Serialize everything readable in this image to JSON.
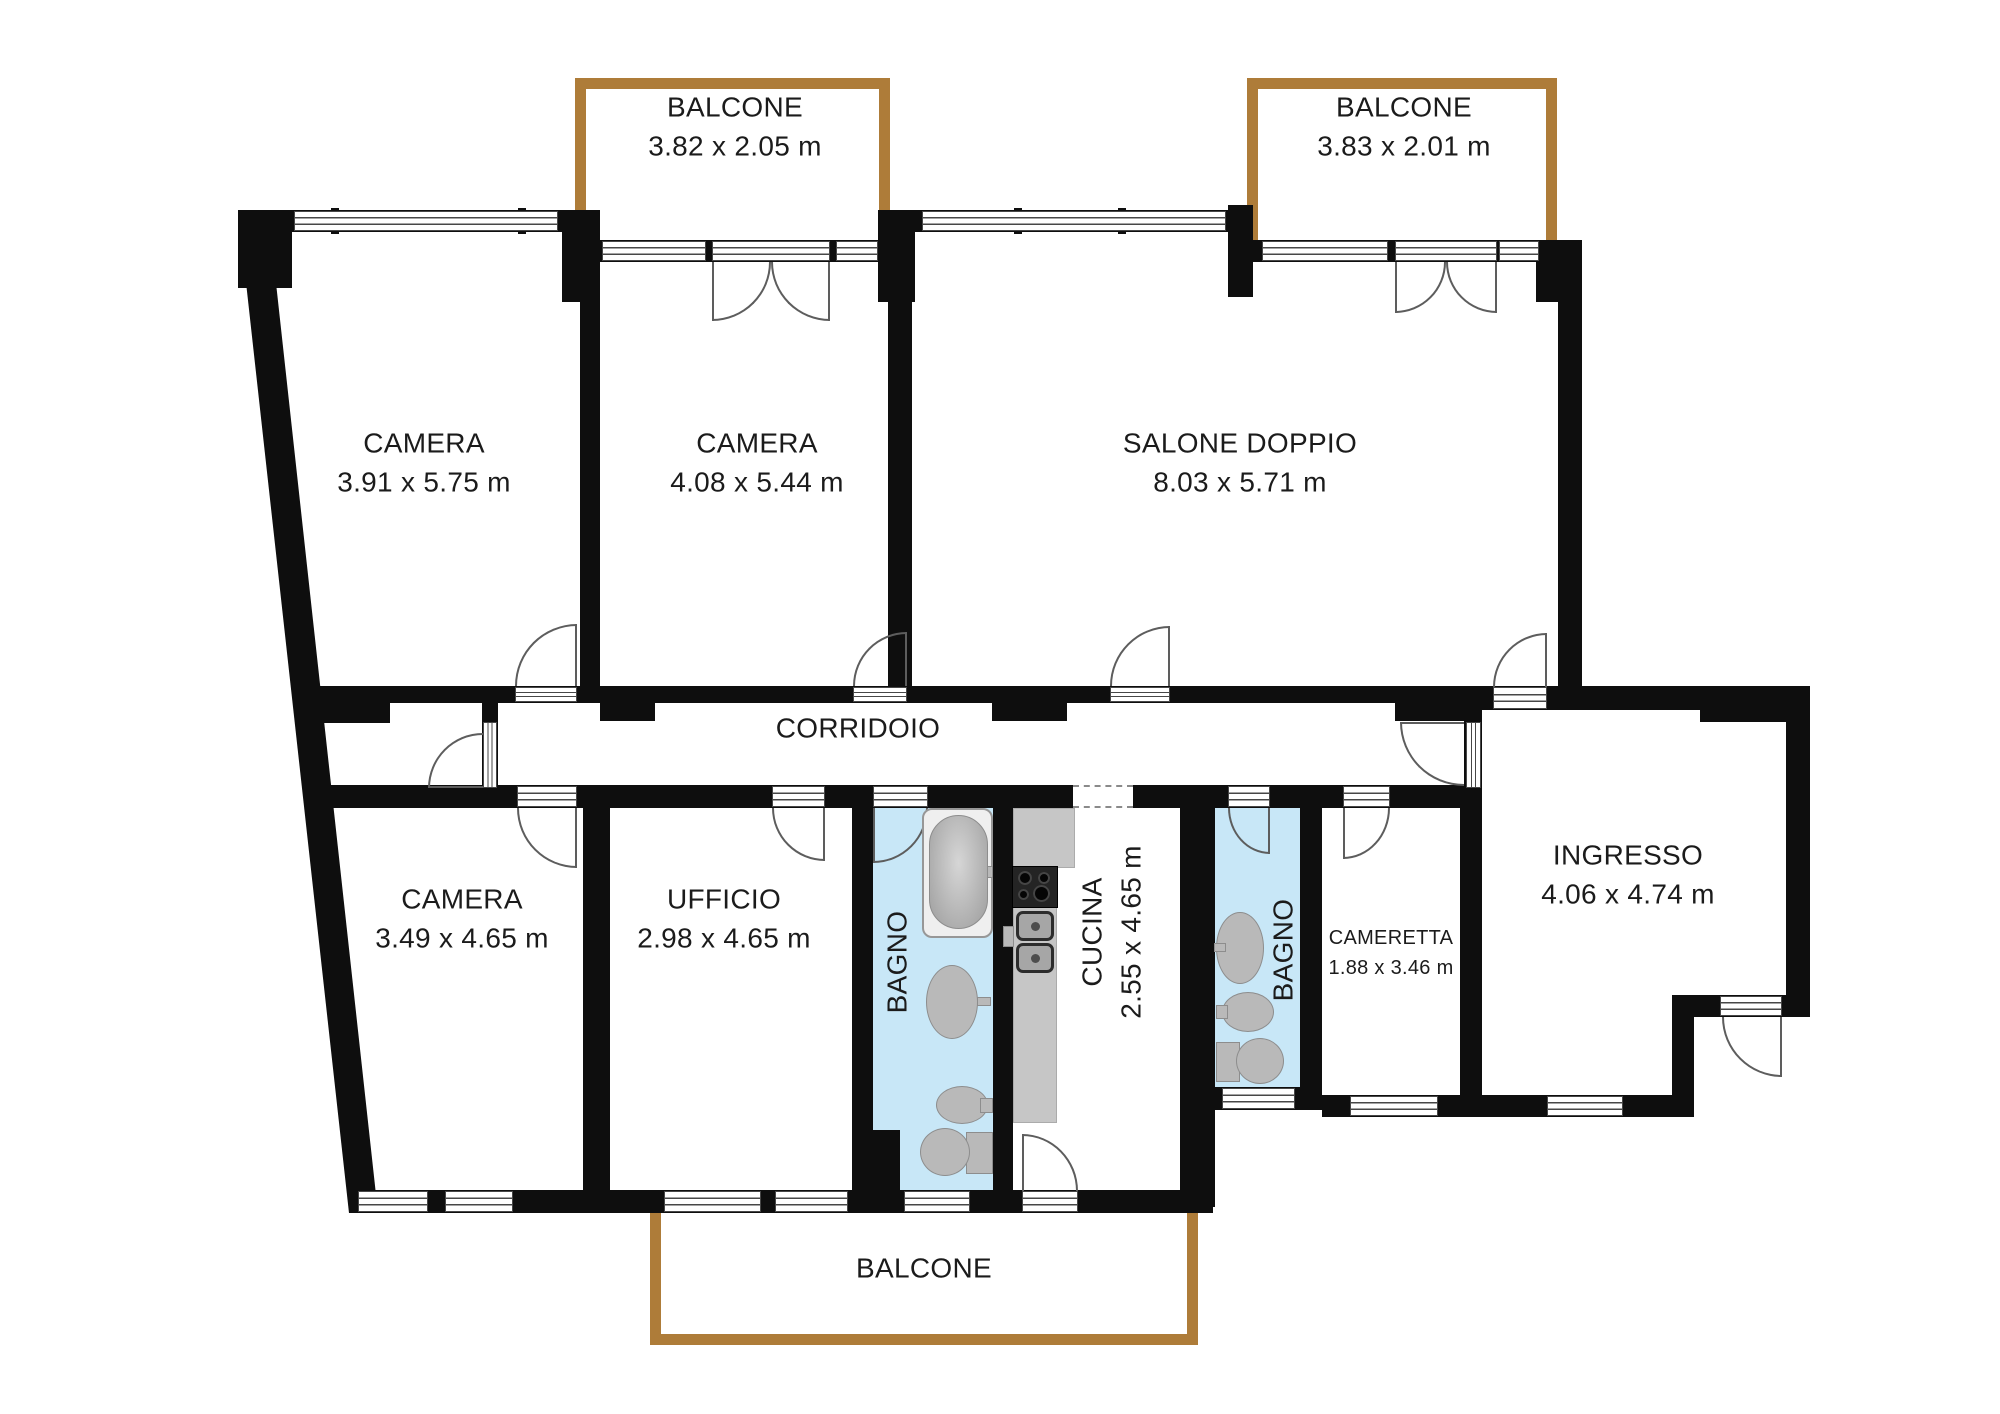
{
  "rooms": {
    "camera_top_left": {
      "name": "CAMERA",
      "dims": "3.91 x 5.75 m"
    },
    "camera_top_mid": {
      "name": "CAMERA",
      "dims": "4.08 x 5.44 m"
    },
    "salone": {
      "name": "SALONE DOPPIO",
      "dims": "8.03 x 5.71 m"
    },
    "corridoio": {
      "name": "CORRIDOIO"
    },
    "camera_bottom": {
      "name": "CAMERA",
      "dims": "3.49 x 4.65 m"
    },
    "ufficio": {
      "name": "UFFICIO",
      "dims": "2.98 x 4.65 m"
    },
    "bagno1": {
      "name": "BAGNO"
    },
    "cucina": {
      "name": "CUCINA",
      "dims": "2.55 x 4.65 m"
    },
    "bagno2": {
      "name": "BAGNO"
    },
    "cameretta": {
      "name": "CAMERETTA",
      "dims": "1.88 x 3.46 m"
    },
    "ingresso": {
      "name": "INGRESSO",
      "dims": "4.06 x 4.74 m"
    },
    "balcone_top_left": {
      "name": "BALCONE",
      "dims": "3.82 x 2.05 m"
    },
    "balcone_top_right": {
      "name": "BALCONE",
      "dims": "3.83 x 2.01 m"
    },
    "balcone_bottom": {
      "name": "BALCONE"
    }
  },
  "fixtures": {
    "bagno1": [
      "bathtub-icon",
      "washbasin-icon",
      "bidet-icon",
      "toilet-icon"
    ],
    "bagno2": [
      "washbasin-icon",
      "bidet-icon",
      "toilet-icon"
    ],
    "cucina": [
      "counter-icon",
      "stove-icon",
      "kitchen-sink-icon"
    ]
  },
  "colors": {
    "wall": "#0e0e0e",
    "bath_floor": "#c8e7f7",
    "balcony_border": "#ae7c39",
    "fixture_gray": "#b9b9b9"
  }
}
